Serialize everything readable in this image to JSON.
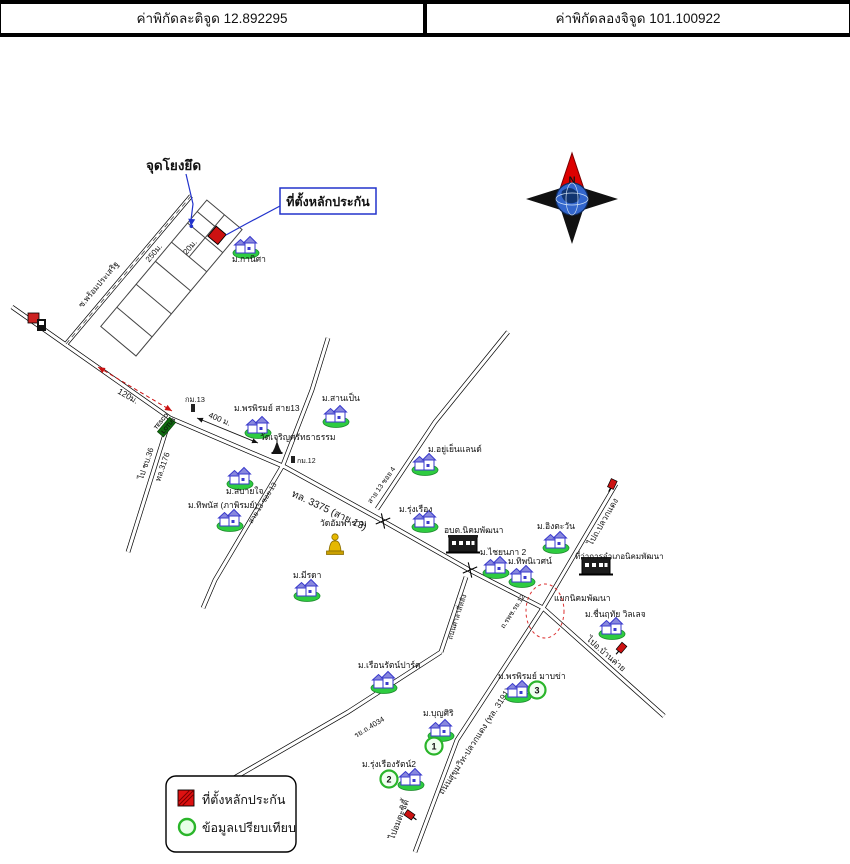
{
  "header": {
    "latitude": "ค่าพิกัดละติจูด 12.892295",
    "longitude": "ค่าพิกัดลองจิจูด 101.100922"
  },
  "map": {
    "anchor_label": "จุดโยงยึด",
    "collateral_label": "ที่ตั้งหลักประกัน",
    "distances": {
      "d20": "20ม.",
      "d250": "250ม.",
      "d120": "120ม.",
      "d400": "400 ม."
    },
    "roads": {
      "soi_promprasert": "ซ.พร้อมประเสริฐ",
      "to_chonburi36": "ไป ชบ.36",
      "hw3176": "ทล.3176",
      "km13": "กม.13",
      "km12": "กม.12",
      "hw3375": "ทล. 3375 (สาย 13)",
      "soi13_13": "สาย 13 ซอย 13",
      "soi13_4": "สาย 13 ซอย 4",
      "sala_road": "ถนนศาลาสี่หลัง",
      "rpch12": "ถ.รพช.รย.12",
      "ry4034": "รย.ถ.4034",
      "hw3191": "ถนนสุขุมวิท-ปลวกแดง (ทล. 3191)",
      "to_pluakdaeng": "ไปถ.ปลวกแดง",
      "to_bankhai": "ไปอ.บ้านค่าย",
      "to_amata": "ไปอมตะซิตี้",
      "junction": "แยกนิคมพัฒนา"
    },
    "sign": {
      "tesco": "TESCO",
      "lotus": "LOTUS"
    },
    "places": {
      "kanisa": "ม.กานิศา",
      "pornpirom13": "ม.พรพิรมย์ สาย13",
      "sanpen": "ม.สานเป็น",
      "wat_charoen": "วัดเจริญศรัทธาธรรม",
      "yuyen": "ม.อยู่เย็นแลนด์",
      "sabaijai": "ม.สบายใจ",
      "tipanat": "ม.ทิพนัส (ภาพิรมย์)",
      "meerada": "ม.มีรดา",
      "wat_ampharam": "วัดอัมพาราม",
      "rungrueang": "ม.รุ่งเรือง",
      "obt": "อบต.นิคมพัฒนา",
      "chainapa2": "ม.ไชยนภา 2",
      "tipniwet": "ม.ทิพนิเวศน์",
      "ingtawan": "ม.อิงตะวัน",
      "amphoe": "ที่ว่าการอำเภอนิคมพัฒนา",
      "chuen": "ม.ชื่นฤทัย วิลเลจ",
      "rueanrat": "ม.เรือนรัตน์ปาร์ค",
      "pornpirom_mabkha": "ม.พรพิรมย์ มาบข่า",
      "boonsiri": "ม.บุญศิริ",
      "rungrueangrat2": "ม.รุ่งเรืองรัตน์2"
    },
    "numbers": {
      "n1": "1",
      "n2": "2",
      "n3": "3"
    },
    "compass": {
      "n": "N",
      "e": "E",
      "w": "W",
      "s": "S"
    },
    "legend": {
      "collateral": "ที่ตั้งหลักประกัน",
      "comparison": "ข้อมูลเปรียบเทียบ"
    },
    "colors": {
      "annotation_blue": "#2233cc",
      "alert_red": "#cc1111",
      "compare_green": "#2ab52a"
    }
  }
}
